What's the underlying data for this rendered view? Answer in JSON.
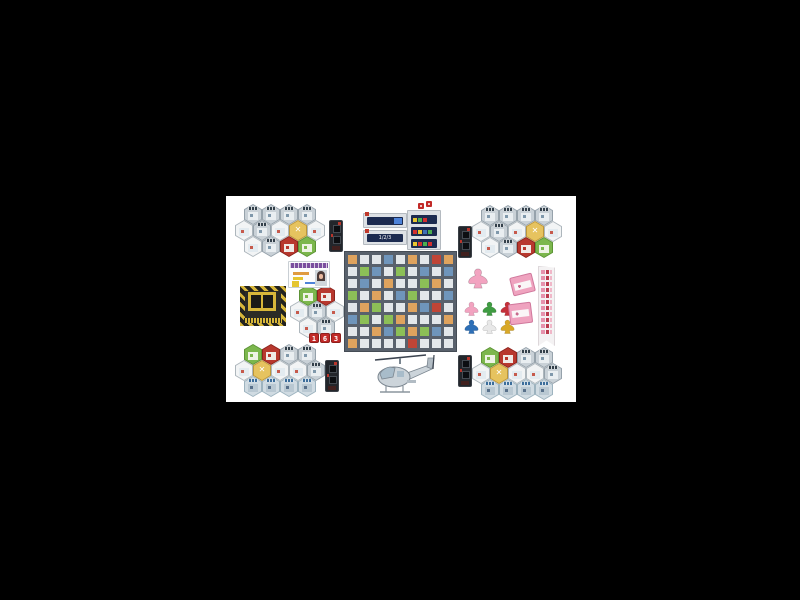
{
  "scene": {
    "description": "Tabletop board game components photographed on a white background",
    "canvas_bg": "#000000",
    "photo_bg": "#ffffff"
  },
  "hex_types": {
    "gray": {
      "fill": "#c9d1d7",
      "border": "#96a2ab",
      "cap": "#33404b",
      "art": "#e9eef1",
      "spot": "#7f98ab"
    },
    "white": {
      "fill": "#f2f4f5",
      "border": "#adb6bc",
      "cap": null,
      "art": "#e3ebf0",
      "spot": "#c65a4c"
    },
    "yellow": {
      "fill": "#e6c35f",
      "border": "#bd9638",
      "cap": null,
      "art": null,
      "glyph": "✕",
      "glyph_color": "#ffffff"
    },
    "red": {
      "fill": "#b8382e",
      "border": "#8c241d",
      "cap": null,
      "art": "#f0eae6",
      "spot": "#b8382e"
    },
    "green": {
      "fill": "#7cb74d",
      "border": "#5c9336",
      "cap": null,
      "art": "#eef3e5",
      "spot": "#7cb74d"
    },
    "blue": {
      "fill": "#d0dbe2",
      "border": "#9db3bf",
      "cap": "#3c6e9b",
      "art": "#b9c8d2",
      "spot": "#58708a"
    }
  },
  "clusters": {
    "top_left": {
      "rows": [
        {
          "dx": 9,
          "tiles": [
            "gray",
            "gray",
            "gray",
            "gray"
          ]
        },
        {
          "dx": 0,
          "tiles": [
            "white",
            "gray",
            "white",
            "yellow",
            "white"
          ]
        },
        {
          "dx": 9,
          "tiles": [
            "white",
            "gray",
            "red",
            "green"
          ]
        }
      ]
    },
    "top_right": {
      "rows": [
        {
          "dx": 9,
          "tiles": [
            "gray",
            "gray",
            "gray",
            "gray"
          ]
        },
        {
          "dx": 0,
          "tiles": [
            "white",
            "gray",
            "white",
            "yellow",
            "white"
          ]
        },
        {
          "dx": 9,
          "tiles": [
            "white",
            "gray",
            "red",
            "green"
          ]
        }
      ]
    },
    "bottom_left": {
      "rows": [
        {
          "dx": 9,
          "tiles": [
            "green",
            "red",
            "gray",
            "gray"
          ]
        },
        {
          "dx": 0,
          "tiles": [
            "white",
            "yellow",
            "white",
            "white",
            "gray"
          ]
        },
        {
          "dx": 9,
          "tiles": [
            "blue",
            "blue",
            "blue",
            "blue"
          ]
        }
      ]
    },
    "bottom_right": {
      "rows": [
        {
          "dx": 9,
          "tiles": [
            "green",
            "red",
            "gray",
            "gray"
          ]
        },
        {
          "dx": 0,
          "tiles": [
            "white",
            "yellow",
            "white",
            "white",
            "gray"
          ]
        },
        {
          "dx": 9,
          "tiles": [
            "blue",
            "blue",
            "blue",
            "blue"
          ]
        }
      ]
    },
    "mini": {
      "rows": [
        {
          "dx": 9,
          "tiles": [
            "green",
            "red"
          ]
        },
        {
          "dx": 0,
          "tiles": [
            "white",
            "gray",
            "white"
          ]
        },
        {
          "dx": 9,
          "tiles": [
            "white",
            "gray"
          ]
        }
      ]
    }
  },
  "board": {
    "road_color": "#59616c",
    "cell_colors": {
      "gray": "#e3e7ea",
      "green": "#8cbf57",
      "tan": "#dfa35e",
      "blue": "#6f95bb",
      "red": "#c04536"
    },
    "cells": [
      [
        "tan",
        "gray",
        "gray",
        "blue",
        "gray",
        "tan",
        "gray",
        "red",
        "tan"
      ],
      [
        "gray",
        "green",
        "blue",
        "gray",
        "green",
        "gray",
        "blue",
        "gray",
        "blue"
      ],
      [
        "gray",
        "blue",
        "gray",
        "tan",
        "gray",
        "gray",
        "green",
        "tan",
        "gray"
      ],
      [
        "green",
        "gray",
        "tan",
        "gray",
        "blue",
        "green",
        "gray",
        "gray",
        "blue"
      ],
      [
        "gray",
        "tan",
        "green",
        "gray",
        "gray",
        "tan",
        "blue",
        "red",
        "gray"
      ],
      [
        "blue",
        "green",
        "gray",
        "green",
        "tan",
        "gray",
        "gray",
        "gray",
        "tan"
      ],
      [
        "gray",
        "gray",
        "tan",
        "blue",
        "green",
        "tan",
        "green",
        "blue",
        "gray"
      ],
      [
        "tan",
        "gray",
        "gray",
        "gray",
        "gray",
        "red",
        "gray",
        "gray",
        "gray"
      ]
    ]
  },
  "dice": {
    "color": "#c22a28",
    "values": [
      "1",
      "6",
      "3"
    ]
  },
  "dispatch": {
    "left_cards": [
      {
        "type": "screen"
      },
      {
        "type": "label",
        "label": "1/2/3"
      }
    ],
    "right_rows": [
      [
        "#e8c530",
        "#4caf50",
        "#d32f2f"
      ],
      [
        "#d32f2f",
        "#e8c530",
        "#3f6fb5",
        "#4caf50"
      ],
      [
        "#e8c530",
        "#d32f2f",
        "#4caf50",
        "#d32f2f"
      ]
    ]
  },
  "meeples": {
    "large": "#f2a3c0",
    "small": [
      [
        "#f2a3c0",
        "#3f9c42",
        "#c5303a"
      ],
      [
        "#2d6fb7",
        "#e8e8e8",
        "#d9a827"
      ]
    ]
  },
  "banner": {
    "rows": 11,
    "icon_colors": [
      "#e693ad",
      "#b93a4c",
      "#f0b7c8"
    ]
  },
  "id_card": {
    "header": "#7b4f9e",
    "hair": "#4a3a38",
    "skin": "#e8b9a0",
    "accent1": "#e09b3f",
    "accent2": "#e5c530",
    "accent3": "#4d82d8"
  },
  "hazard": {
    "stripe_yellow": "#d8b73a",
    "stripe_dark": "#23231f",
    "panel": "#2b2b26"
  },
  "helicopter": {
    "body": "#ccd4da",
    "outline": "#7b8690",
    "glass": "#a8bcca",
    "rotor": "#3c4450"
  },
  "stacks": {
    "color": "#efa3bf",
    "border": "#d0789c"
  },
  "tower": {
    "body": "#23262b",
    "accent": "#b8352b"
  }
}
